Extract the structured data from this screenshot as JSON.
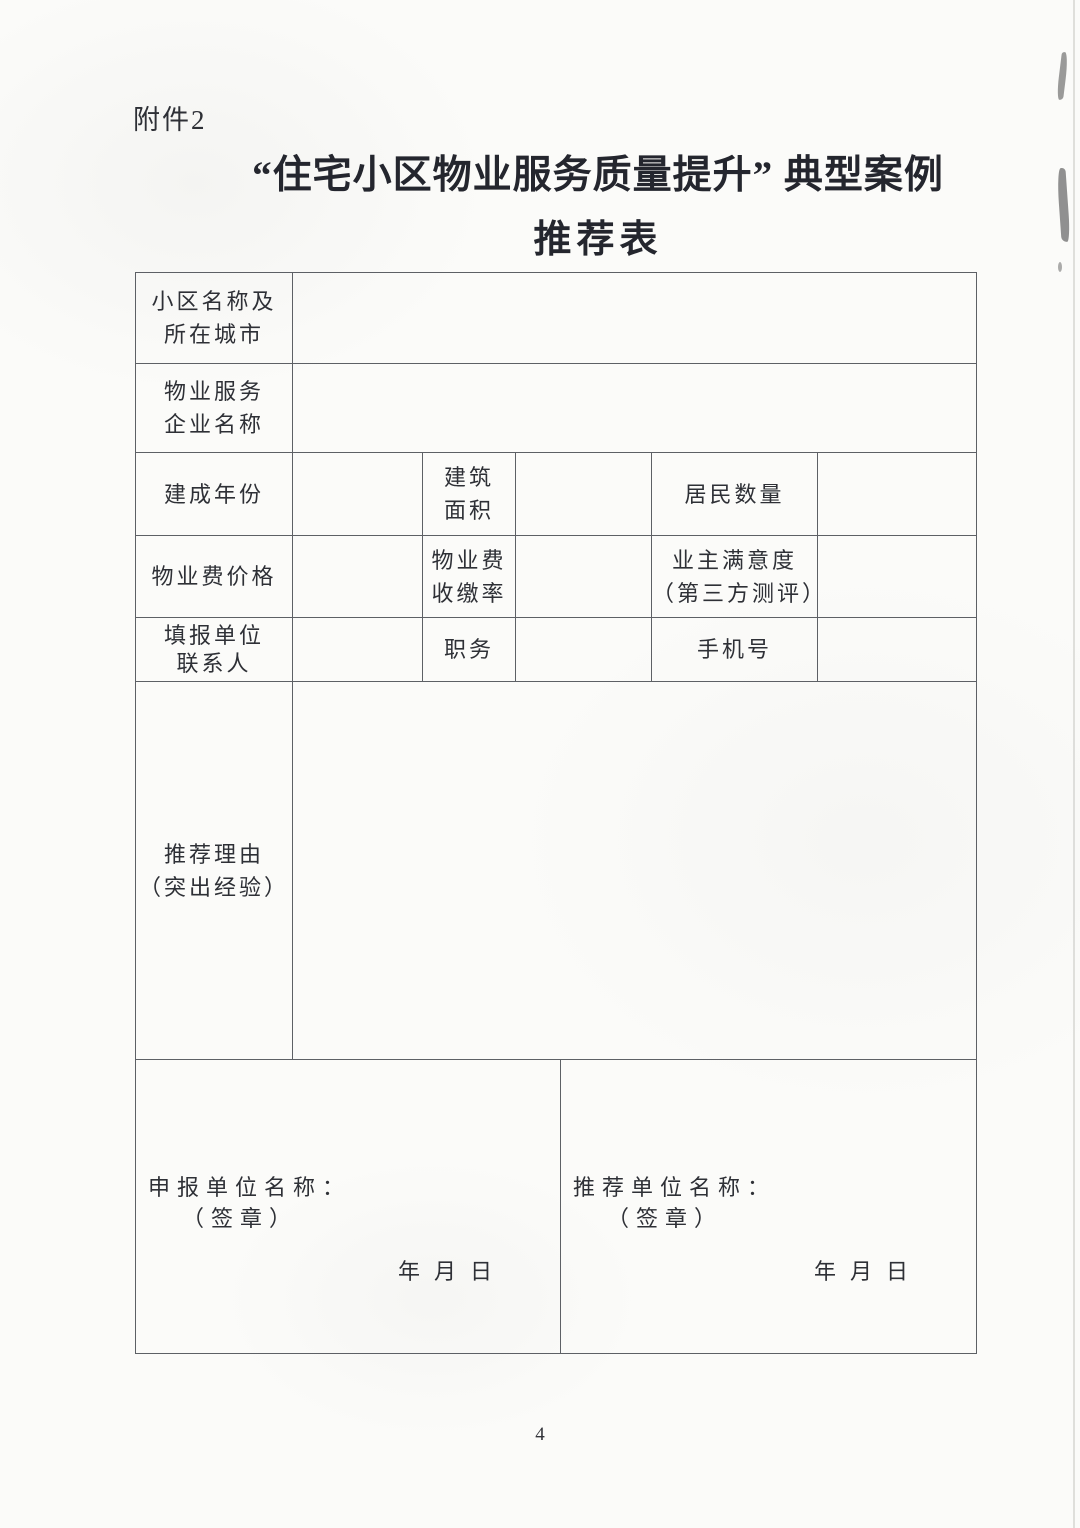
{
  "colors": {
    "paper": "#fbfbf9",
    "ink": "#2e3036",
    "table_border": "#5d6065"
  },
  "page": {
    "attachment_label": "附件2",
    "title_line1": "“住宅小区物业服务质量提升” 典型案例",
    "title_line2": "推荐表",
    "page_number": "4"
  },
  "fields": {
    "community_name": {
      "label_line1": "小区名称及",
      "label_line2": "所在城市",
      "value": ""
    },
    "company_name": {
      "label_line1": "物业服务",
      "label_line2": "企业名称",
      "value": ""
    },
    "year_built": {
      "label": "建成年份",
      "value": ""
    },
    "building_area": {
      "label_line1": "建筑",
      "label_line2": "面积",
      "value": ""
    },
    "residents_count": {
      "label": "居民数量",
      "value": ""
    },
    "fee_price": {
      "label": "物业费价格",
      "value": ""
    },
    "fee_collection_rate": {
      "label_line1": "物业费",
      "label_line2": "收缴率",
      "value": ""
    },
    "owner_satisfaction": {
      "label_line1": "业主满意度",
      "label_line2": "（第三方测评）",
      "value": ""
    },
    "contact_person": {
      "label_line1": "填报单位",
      "label_line2": "联系人",
      "value": ""
    },
    "position": {
      "label": "职务",
      "value": ""
    },
    "mobile": {
      "label": "手机号",
      "value": ""
    },
    "recommendation_reason": {
      "label_line1": "推荐理由",
      "label_line2": "（突出经验）",
      "value": ""
    }
  },
  "signatures": {
    "applicant": {
      "name_label": "申报单位名称：",
      "seal_label": "（签章）",
      "date_label": "年月日"
    },
    "recommender": {
      "name_label": "推荐单位名称：",
      "seal_label": "（签章）",
      "date_label": "年月日"
    }
  }
}
